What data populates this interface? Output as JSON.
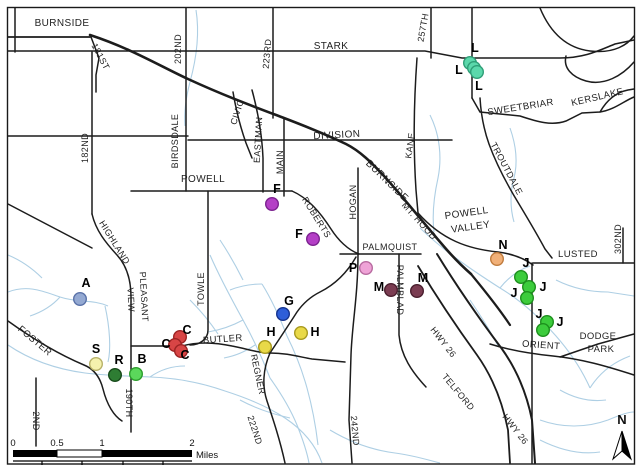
{
  "map": {
    "frame_color": "#1a1a1a",
    "road_color": "#1c1c1c",
    "creek_color": "#aecfe4",
    "background": "#ffffff",
    "road_labels": [
      {
        "text": "BURNSIDE",
        "x": 62,
        "y": 26,
        "rot": 0,
        "size": 10
      },
      {
        "text": "181ST",
        "x": 98,
        "y": 58,
        "rot": 62,
        "size": 9
      },
      {
        "text": "202ND",
        "x": 181,
        "y": 49,
        "rot": -90,
        "size": 9
      },
      {
        "text": "182ND",
        "x": 88,
        "y": 148,
        "rot": -90,
        "size": 9
      },
      {
        "text": "BIRDSDALE",
        "x": 178,
        "y": 141,
        "rot": -90,
        "size": 9
      },
      {
        "text": "223RD",
        "x": 270,
        "y": 54,
        "rot": -85,
        "size": 9
      },
      {
        "text": "STARK",
        "x": 331,
        "y": 49,
        "rot": 0,
        "size": 10
      },
      {
        "text": "257TH",
        "x": 426,
        "y": 28,
        "rot": -80,
        "size": 9
      },
      {
        "text": "CIVIC",
        "x": 240,
        "y": 113,
        "rot": -72,
        "size": 9
      },
      {
        "text": "EASTMAN",
        "x": 261,
        "y": 140,
        "rot": -87,
        "size": 9
      },
      {
        "text": "MAIN",
        "x": 283,
        "y": 162,
        "rot": -90,
        "size": 9
      },
      {
        "text": "DIVISION",
        "x": 337,
        "y": 138,
        "rot": -3,
        "size": 10
      },
      {
        "text": "KANE",
        "x": 413,
        "y": 146,
        "rot": -82,
        "size": 9
      },
      {
        "text": "SWEETBRIAR",
        "x": 521,
        "y": 110,
        "rot": -9,
        "size": 9.5
      },
      {
        "text": "KERSLAKE",
        "x": 598,
        "y": 100,
        "rot": -13,
        "size": 9.5
      },
      {
        "text": "TROUTDALE",
        "x": 504,
        "y": 170,
        "rot": 62,
        "size": 9
      },
      {
        "text": "POWELL",
        "x": 203,
        "y": 182,
        "rot": 0,
        "size": 10
      },
      {
        "text": "ROBERTS",
        "x": 314,
        "y": 219,
        "rot": 58,
        "size": 9
      },
      {
        "text": "HOGAN",
        "x": 356,
        "y": 202,
        "rot": -90,
        "size": 9
      },
      {
        "text": "BURNSIDE",
        "x": 385,
        "y": 183,
        "rot": 44,
        "size": 10
      },
      {
        "text": "MT. HOOD",
        "x": 417,
        "y": 223,
        "rot": 48,
        "size": 9
      },
      {
        "text": "POWELL",
        "x": 467,
        "y": 216,
        "rot": -8,
        "size": 10
      },
      {
        "text": "VALLEY",
        "x": 471,
        "y": 230,
        "rot": -8,
        "size": 10
      },
      {
        "text": "PALMQUIST",
        "x": 390,
        "y": 250,
        "rot": 0,
        "size": 9
      },
      {
        "text": "LUSTED",
        "x": 578,
        "y": 257,
        "rot": 0,
        "size": 9.5
      },
      {
        "text": "302ND",
        "x": 621,
        "y": 239,
        "rot": -90,
        "size": 9
      },
      {
        "text": "PALMBLAD",
        "x": 397,
        "y": 290,
        "rot": 90,
        "size": 9
      },
      {
        "text": "TOWLE",
        "x": 204,
        "y": 289,
        "rot": -90,
        "size": 9
      },
      {
        "text": "HIGHLAND",
        "x": 112,
        "y": 244,
        "rot": 58,
        "size": 9
      },
      {
        "text": "PLEASANT",
        "x": 141,
        "y": 297,
        "rot": 87,
        "size": 9
      },
      {
        "text": "VIEW",
        "x": 128,
        "y": 300,
        "rot": 87,
        "size": 9
      },
      {
        "text": "BUTLER",
        "x": 223,
        "y": 342,
        "rot": -4,
        "size": 9.5
      },
      {
        "text": "FOSTER",
        "x": 33,
        "y": 343,
        "rot": 40,
        "size": 9.5
      },
      {
        "text": "2ND",
        "x": 33,
        "y": 421,
        "rot": 90,
        "size": 9
      },
      {
        "text": "190TH",
        "x": 126,
        "y": 403,
        "rot": 90,
        "size": 9
      },
      {
        "text": "REGNER",
        "x": 255,
        "y": 375,
        "rot": 78,
        "size": 9
      },
      {
        "text": "222ND",
        "x": 252,
        "y": 431,
        "rot": 72,
        "size": 9
      },
      {
        "text": "242ND",
        "x": 352,
        "y": 431,
        "rot": 85,
        "size": 9
      },
      {
        "text": "HWY 26",
        "x": 441,
        "y": 344,
        "rot": 52,
        "size": 9
      },
      {
        "text": "TELFORD",
        "x": 456,
        "y": 394,
        "rot": 50,
        "size": 9
      },
      {
        "text": "HWY 26",
        "x": 513,
        "y": 431,
        "rot": 52,
        "size": 9
      },
      {
        "text": "ORIENT",
        "x": 541,
        "y": 348,
        "rot": 4,
        "size": 9.5
      },
      {
        "text": "DODGE",
        "x": 598,
        "y": 339,
        "rot": 0,
        "size": 9.5
      },
      {
        "text": "PARK",
        "x": 601,
        "y": 352,
        "rot": 0,
        "size": 9.5
      }
    ],
    "markers": [
      {
        "letter": "A",
        "x": 80,
        "y": 299,
        "lx": 86,
        "ly": 287,
        "fill": "#94a9d2",
        "stroke": "#5a72a8"
      },
      {
        "letter": "S",
        "x": 96,
        "y": 364,
        "lx": 96,
        "ly": 353,
        "fill": "#f5f2ae",
        "stroke": "#b8b269"
      },
      {
        "letter": "R",
        "x": 115,
        "y": 375,
        "lx": 119,
        "ly": 364,
        "fill": "#2e7d33",
        "stroke": "#174a1b"
      },
      {
        "letter": "B",
        "x": 136,
        "y": 374,
        "lx": 142,
        "ly": 363,
        "fill": "#5bd75b",
        "stroke": "#2c9e2c"
      },
      {
        "letter": "C",
        "x": 180,
        "y": 337,
        "lx": 187,
        "ly": 334,
        "fill": "#d84545",
        "stroke": "#9c2323"
      },
      {
        "letter": "C",
        "x": 175,
        "y": 345,
        "lx": 166,
        "ly": 348,
        "fill": "#d84545",
        "stroke": "#9c2323"
      },
      {
        "letter": "C",
        "x": 181,
        "y": 351,
        "lx": 185,
        "ly": 359,
        "fill": "#d84545",
        "stroke": "#9c2323"
      },
      {
        "letter": "F",
        "x": 272,
        "y": 204,
        "lx": 277,
        "ly": 193,
        "fill": "#b43fc6",
        "stroke": "#7c2390"
      },
      {
        "letter": "F",
        "x": 313,
        "y": 239,
        "lx": 299,
        "ly": 238,
        "fill": "#b43fc6",
        "stroke": "#7c2390"
      },
      {
        "letter": "G",
        "x": 283,
        "y": 314,
        "lx": 289,
        "ly": 305,
        "fill": "#2e5ed8",
        "stroke": "#16348f"
      },
      {
        "letter": "H",
        "x": 265,
        "y": 347,
        "lx": 271,
        "ly": 336,
        "fill": "#e9d948",
        "stroke": "#a89a1f"
      },
      {
        "letter": "H",
        "x": 301,
        "y": 333,
        "lx": 315,
        "ly": 336,
        "fill": "#e9d948",
        "stroke": "#a89a1f"
      },
      {
        "letter": "P",
        "x": 366,
        "y": 268,
        "lx": 353,
        "ly": 272,
        "fill": "#efa3d7",
        "stroke": "#b86ba0"
      },
      {
        "letter": "M",
        "x": 391,
        "y": 290,
        "lx": 379,
        "ly": 291,
        "fill": "#7b3d52",
        "stroke": "#4a1f2e"
      },
      {
        "letter": "M",
        "x": 417,
        "y": 291,
        "lx": 423,
        "ly": 282,
        "fill": "#7b3d52",
        "stroke": "#4a1f2e"
      },
      {
        "letter": "N",
        "x": 497,
        "y": 259,
        "lx": 503,
        "ly": 249,
        "fill": "#f1b078",
        "stroke": "#c07c3e"
      },
      {
        "letter": "J",
        "x": 521,
        "y": 277,
        "lx": 526,
        "ly": 267,
        "fill": "#3ccc3c",
        "stroke": "#1d8f1d"
      },
      {
        "letter": "J",
        "x": 529,
        "y": 287,
        "lx": 543,
        "ly": 291,
        "fill": "#3ccc3c",
        "stroke": "#1d8f1d"
      },
      {
        "letter": "J",
        "x": 527,
        "y": 298,
        "lx": 514,
        "ly": 297,
        "fill": "#3ccc3c",
        "stroke": "#1d8f1d"
      },
      {
        "letter": "J",
        "x": 547,
        "y": 322,
        "lx": 539,
        "ly": 318,
        "fill": "#3ccc3c",
        "stroke": "#1d8f1d"
      },
      {
        "letter": "J",
        "x": 543,
        "y": 330,
        "lx": 560,
        "ly": 326,
        "fill": "#3ccc3c",
        "stroke": "#1d8f1d"
      },
      {
        "letter": "L",
        "x": 470,
        "y": 63,
        "lx": 475,
        "ly": 52,
        "fill": "#5bd8ab",
        "stroke": "#2f9e77"
      },
      {
        "letter": "L",
        "x": 474,
        "y": 68,
        "lx": 459,
        "ly": 74,
        "fill": "#5bd8ab",
        "stroke": "#2f9e77"
      },
      {
        "letter": "L",
        "x": 477,
        "y": 72,
        "lx": 479,
        "ly": 90,
        "fill": "#5bd8ab",
        "stroke": "#2f9e77"
      }
    ],
    "scale_bar": {
      "unit": "Miles",
      "ticks": [
        {
          "label": "0",
          "x": 13
        },
        {
          "label": "0.5",
          "x": 57
        },
        {
          "label": "1",
          "x": 102
        },
        {
          "label": "2",
          "x": 192
        }
      ]
    },
    "north_arrow": {
      "label": "N"
    }
  }
}
